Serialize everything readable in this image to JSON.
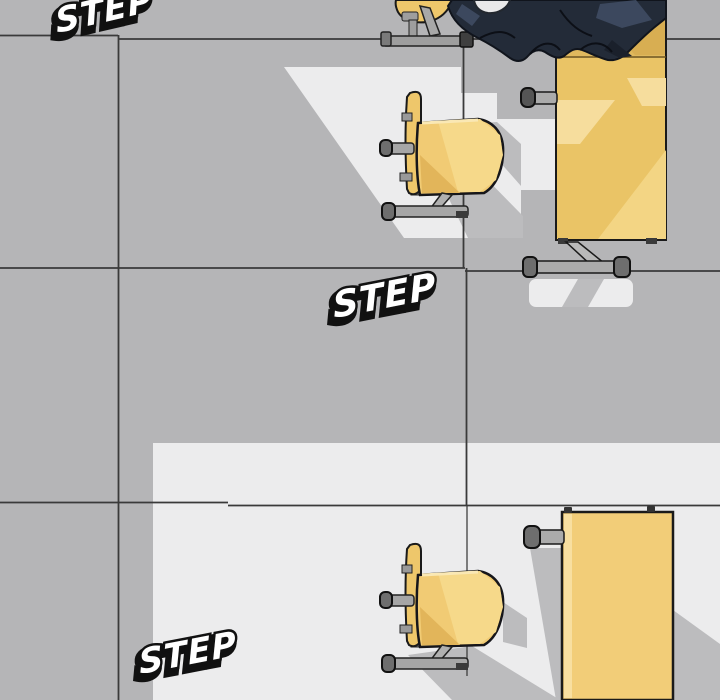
{
  "panel": {
    "type": "webtoon-comic-panel",
    "scene": "top-down classroom: gray tiled floor, window light bands, school desks and chairs, student in dark uniform seated at top-right desk"
  },
  "sfx": {
    "top": "STEP",
    "middle": "STEP",
    "bottom": "STEP"
  },
  "colors": {
    "floor_gray": "#b5b5b7",
    "light_floor": "#ececed",
    "shadow_gray": "#bcbcbe",
    "grid_line": "#3a3a3a",
    "desk_yellow": "#eac466",
    "desk_yellow_dark": "#d8ae52",
    "desk_yellow_light": "#f6dd9d",
    "bottom_desk_yellow": "#f2cd78",
    "chair_yellow": "#f1cb74",
    "chair_yellow_light": "#f6d98a",
    "chair_yellow_dark": "#e2b55a",
    "metal_gray": "#a6a6a6",
    "metal_cap": "#6e6e6e",
    "uniform_navy": "#232b38",
    "uniform_highlight": "#3c485e",
    "outline": "#1a1a1a",
    "sfx_fill": "#ffffff",
    "sfx_outline": "#111111"
  }
}
